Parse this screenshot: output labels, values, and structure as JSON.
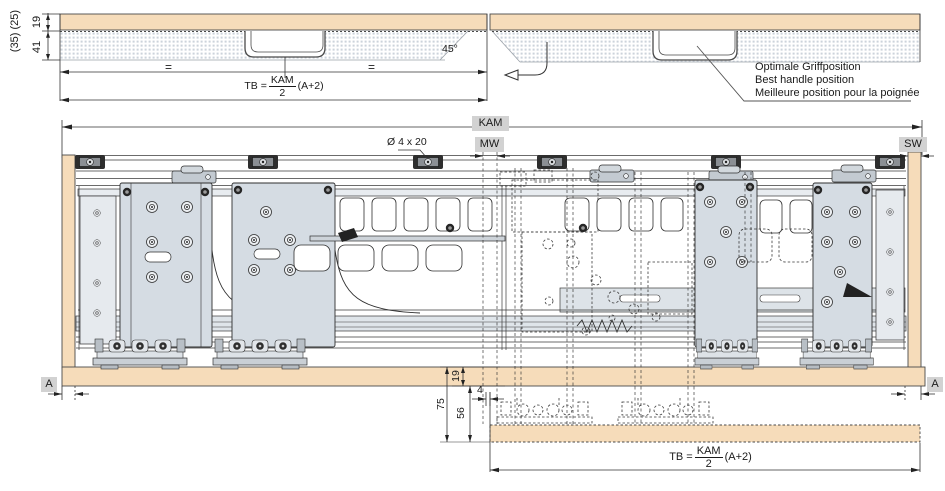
{
  "colors": {
    "panel_tan": "#f6dcba",
    "hardware_gray": "#d5dce3",
    "label_bg": "#d2d2d2",
    "line": "#333333"
  },
  "top_section": {
    "left_view": {
      "dim_overall": "(35) (25)",
      "dim_top_panel": "19",
      "dim_board": "41",
      "equal_mark_left": "=",
      "equal_mark_right": "=",
      "angle_label": "45°",
      "formula": {
        "lhs": "TB =",
        "numerator": "KAM",
        "denominator": "2",
        "factor": "(A+2)"
      }
    },
    "right_view": {
      "handle_note_de": "Optimale Griffposition",
      "handle_note_en": "Best handle position",
      "handle_note_fr": "Meilleure position pour la poignée"
    }
  },
  "main_section": {
    "width_label": "KAM",
    "center_gap_label": "MW",
    "side_wall_label": "SW",
    "screw_label": "Ø 4 x 20",
    "gap_left_label": "A",
    "gap_right_label": "A",
    "dim_bottom_panel": "19",
    "dim_total": "75",
    "dim_clearance": "56",
    "dim_gap": "4",
    "formula": {
      "lhs": "TB =",
      "numerator": "KAM",
      "denominator": "2",
      "factor": "(A+2)"
    }
  }
}
